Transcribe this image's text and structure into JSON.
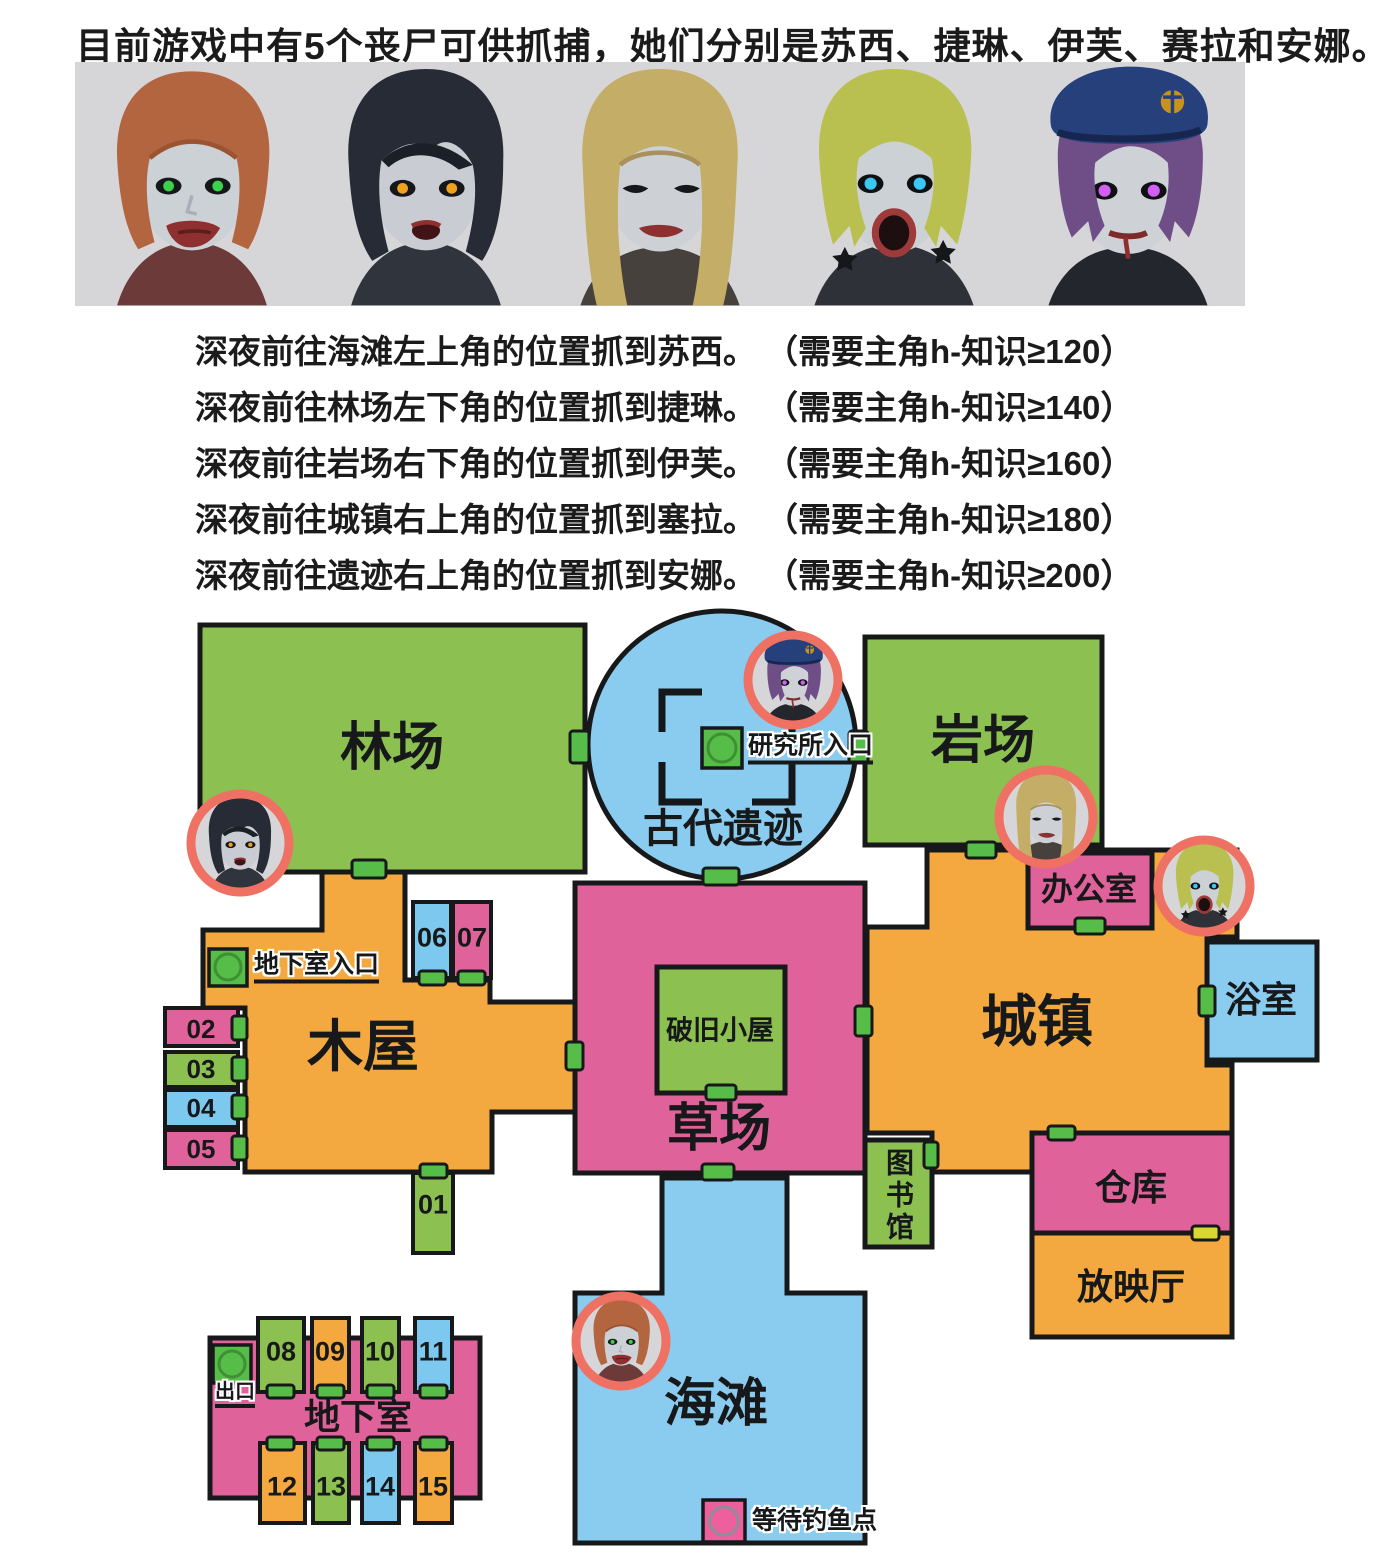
{
  "title": "目前游戏中有5个丧尸可供抓捕，她们分别是苏西、捷琳、伊芙、赛拉和安娜。",
  "instructions": [
    {
      "text": "深夜前往海滩左上角的位置抓到苏西。",
      "req": "（需要主角h-知识≥120）"
    },
    {
      "text": "深夜前往林场左下角的位置抓到捷琳。",
      "req": "（需要主角h-知识≥140）"
    },
    {
      "text": "深夜前往岩场右下角的位置抓到伊芙。",
      "req": "（需要主角h-知识≥160）"
    },
    {
      "text": "深夜前往城镇右上角的位置抓到塞拉。",
      "req": "（需要主角h-知识≥180）"
    },
    {
      "text": "深夜前往遗迹右上角的位置抓到安娜。",
      "req": "（需要主角h-知识≥200）"
    }
  ],
  "characters": [
    {
      "name": "苏西",
      "hair_color": "#b2653e",
      "capture_area": "海滩"
    },
    {
      "name": "捷琳",
      "hair_color": "#262b36",
      "capture_area": "林场"
    },
    {
      "name": "伊芙",
      "hair_color": "#c4ae67",
      "capture_area": "岩场"
    },
    {
      "name": "赛拉",
      "hair_color": "#b9c04f",
      "capture_area": "城镇"
    },
    {
      "name": "安娜",
      "hair_color": "#6f4d87",
      "capture_area": "古代遗迹"
    }
  ],
  "map": {
    "areas": {
      "forest": "林场",
      "ruins": "古代遗迹",
      "quarry": "岩场",
      "town": "城镇",
      "cabin": "木屋",
      "grassland": "草场",
      "beach": "海滩",
      "basement": "地下室",
      "office": "办公室",
      "bathroom": "浴室",
      "library": "图书馆",
      "warehouse": "仓库",
      "screening_room": "放映厅",
      "shabby_hut": "破旧小屋"
    },
    "markers": {
      "research_entrance": "研究所入口",
      "basement_entrance": "地下室入口",
      "exit": "出口",
      "fishing_spot": "等待钓鱼点"
    },
    "rooms": [
      "01",
      "02",
      "03",
      "04",
      "05",
      "06",
      "07",
      "08",
      "09",
      "10",
      "11",
      "12",
      "13",
      "14",
      "15"
    ]
  },
  "colors": {
    "area_green": "#8cc152",
    "area_orange": "#f3a93f",
    "area_pink": "#e0629a",
    "area_blue": "#8accf0",
    "door_green": "#56bd48",
    "door_yellow": "#d9d832",
    "capture_ring": "#ee7164",
    "outline": "#17181a",
    "banner_background": "#d6d6d8",
    "fishing_pink": "#ee5f9d"
  }
}
